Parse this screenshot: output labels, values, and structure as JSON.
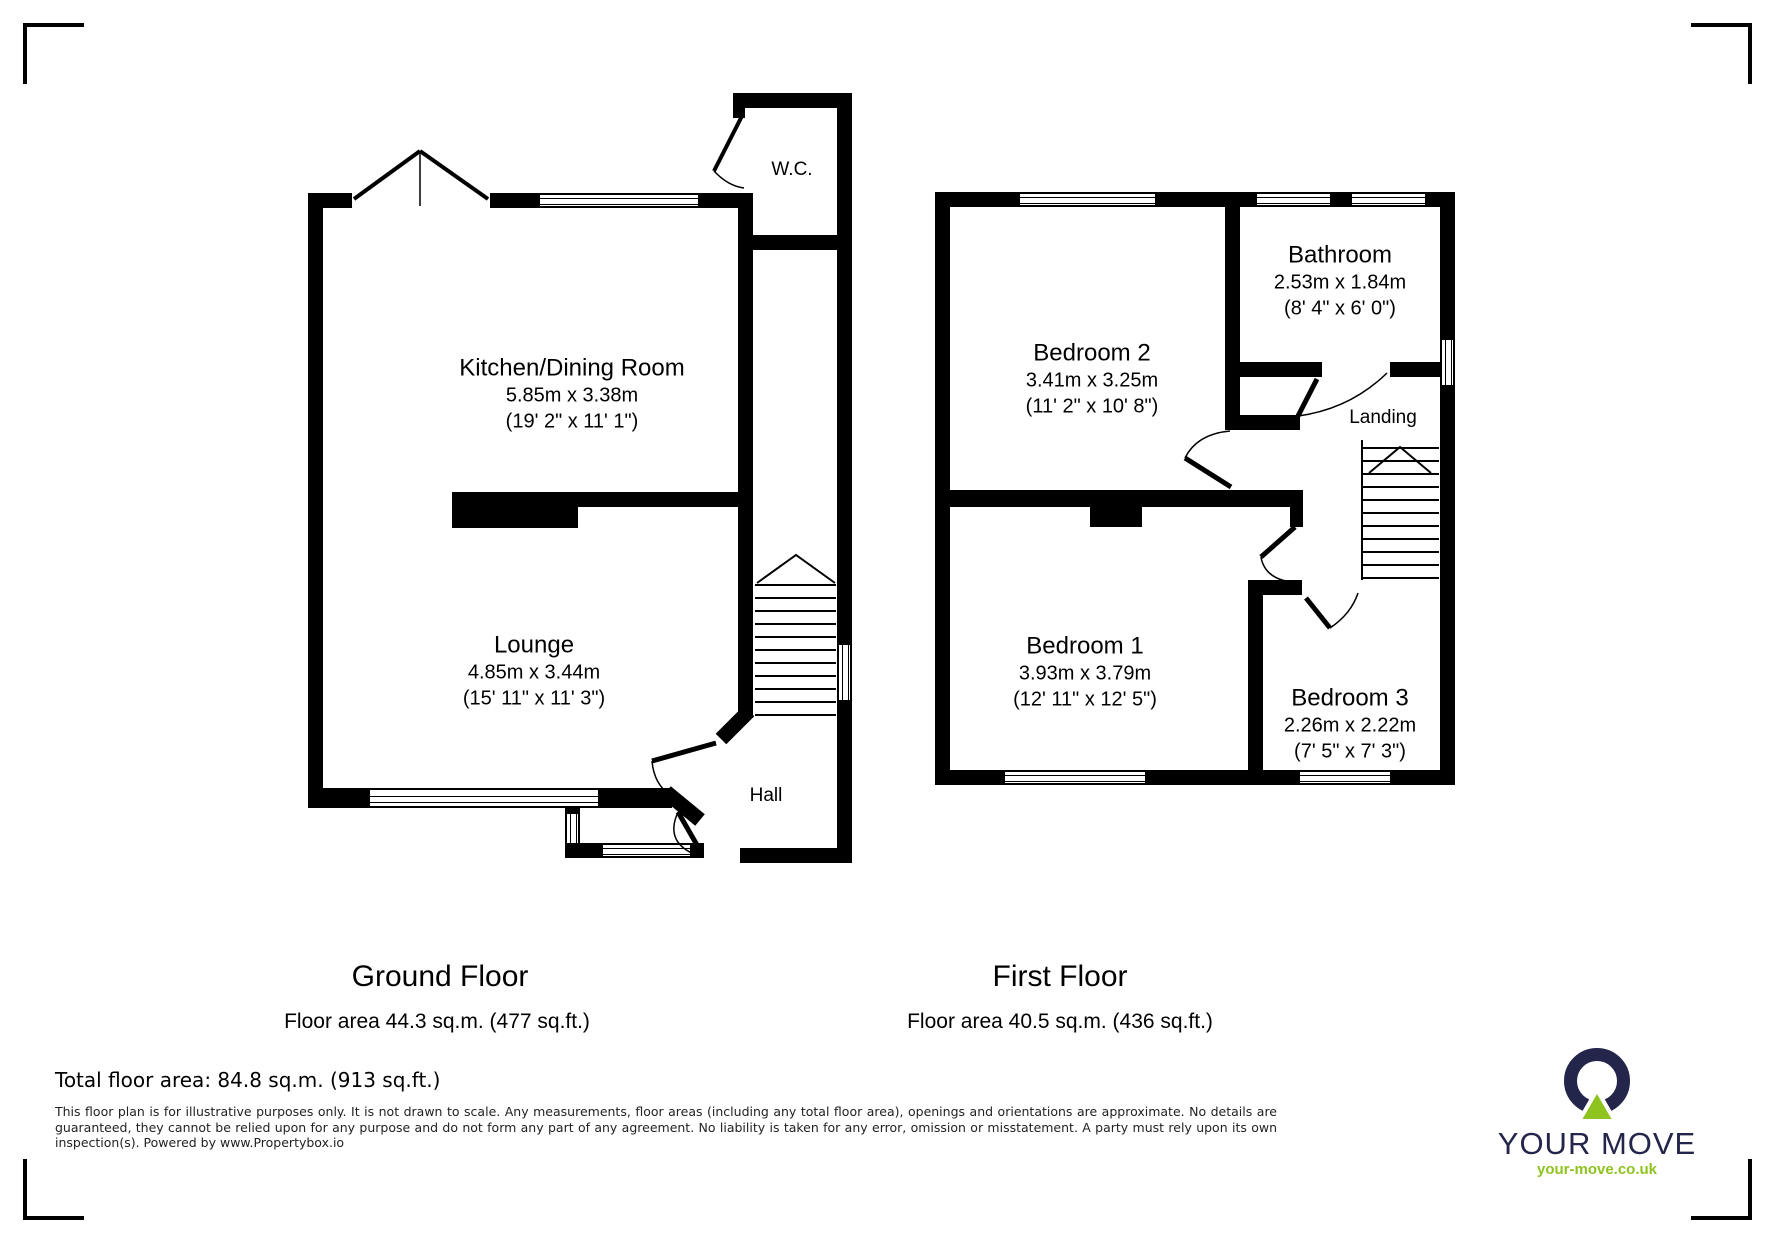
{
  "ground_floor": {
    "title": "Ground Floor",
    "area": "Floor area 44.3 sq.m. (477 sq.ft.)",
    "rooms": {
      "kitchen": {
        "name": "Kitchen/Dining Room",
        "metric": "5.85m x 3.38m",
        "imperial": "(19' 2\" x 11' 1\")"
      },
      "lounge": {
        "name": "Lounge",
        "metric": "4.85m x 3.44m",
        "imperial": "(15' 11\" x 11' 3\")"
      },
      "wc": {
        "name": "W.C."
      },
      "hall": {
        "name": "Hall"
      }
    }
  },
  "first_floor": {
    "title": "First Floor",
    "area": "Floor area 40.5 sq.m. (436 sq.ft.)",
    "rooms": {
      "bedroom2": {
        "name": "Bedroom 2",
        "metric": "3.41m x 3.25m",
        "imperial": "(11' 2\" x 10' 8\")"
      },
      "bathroom": {
        "name": "Bathroom",
        "metric": "2.53m x 1.84m",
        "imperial": "(8' 4\" x 6' 0\")"
      },
      "landing": {
        "name": "Landing"
      },
      "bedroom1": {
        "name": "Bedroom 1",
        "metric": "3.93m x 3.79m",
        "imperial": "(12' 11\" x 12' 5\")"
      },
      "bedroom3": {
        "name": "Bedroom 3",
        "metric": "2.26m x 2.22m",
        "imperial": "(7' 5\" x 7' 3\")"
      }
    }
  },
  "footer": {
    "total": "Total floor area: 84.8 sq.m. (913 sq.ft.)",
    "disclaimer": "This floor plan is for illustrative purposes only. It is not drawn to scale. Any measurements, floor areas (including any total floor area), openings and orientations are approximate. No details are guaranteed, they cannot be relied upon for any purpose and do not form any part of any agreement. No liability is taken for any error, omission or misstatement. A party must rely upon its own inspection(s). Powered by www.Propertybox.io"
  },
  "logo": {
    "brand": "YOUR MOVE",
    "url": "your-move.co.uk",
    "navy": "#24254b",
    "green": "#8fc31f"
  }
}
